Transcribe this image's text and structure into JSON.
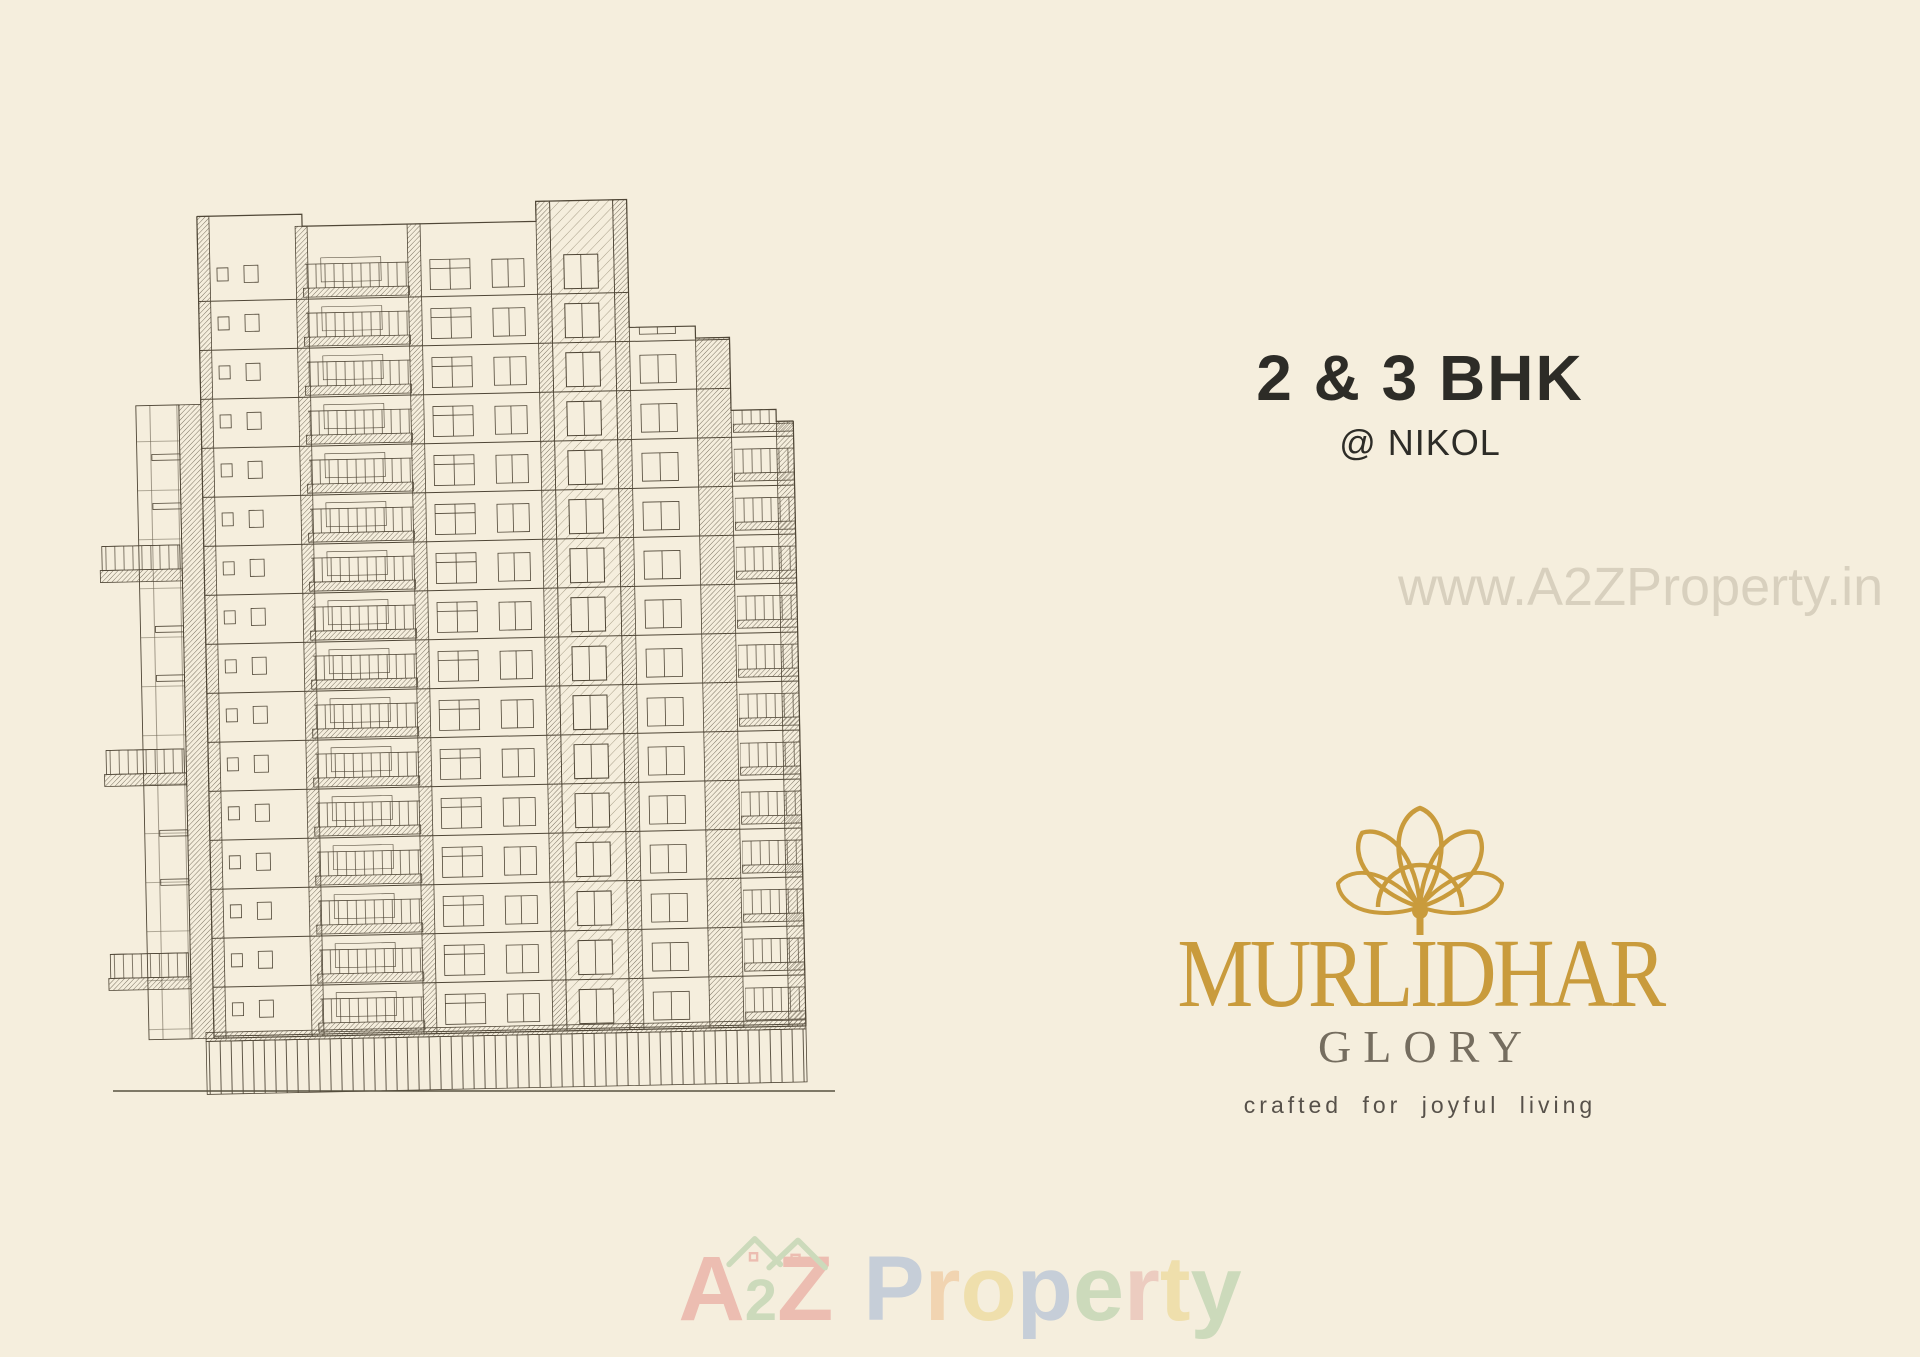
{
  "canvas": {
    "background": "#f5eedd",
    "ink": "#4f4636"
  },
  "hero": {
    "headline": "2 & 3 BHK",
    "location": "@ NIKOL",
    "text_color": "#2d2c27"
  },
  "side_watermark": {
    "text": "www.A2ZProperty.in"
  },
  "brand": {
    "logo_icon": "lotus-flute-icon",
    "name": "MURLIDHAR",
    "sub_name": "GLORY",
    "tagline": "crafted for joyful living",
    "gold": "#c99b3c",
    "sub_color": "#756d5f",
    "tagline_color": "#57514a"
  },
  "bottom_watermark": {
    "word1_letters": [
      [
        "A",
        "#d94f4f"
      ],
      [
        "2",
        "#6fae6f",
        "small"
      ],
      [
        "Z",
        "#d94f4f"
      ]
    ],
    "word2_letters": [
      [
        "P",
        "#5b87cf"
      ],
      [
        "r",
        "#e89a4e"
      ],
      [
        "o",
        "#e3bd3f"
      ],
      [
        "p",
        "#5b87cf"
      ],
      [
        "e",
        "#6fae6f"
      ],
      [
        "r",
        "#d98080"
      ],
      [
        "t",
        "#e3bd3f"
      ],
      [
        "y",
        "#6fae6f"
      ]
    ],
    "roof_icon_color": "#6fae6f",
    "roof_accent_color": "#d94f4f"
  },
  "illustration": {
    "name": "building-elevation-wireframe",
    "floors": 16,
    "has_ground_line": true
  }
}
